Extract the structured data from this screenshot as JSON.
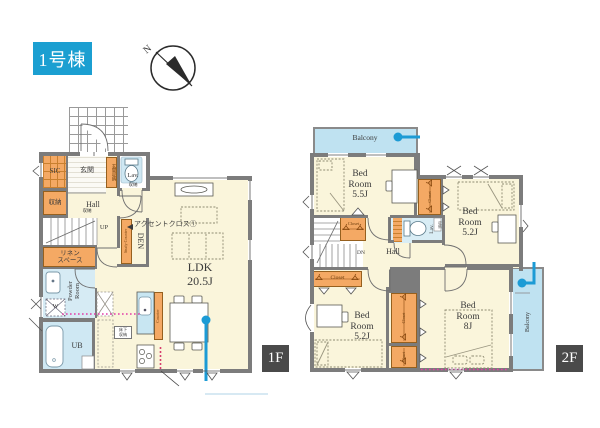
{
  "header": {
    "building": "1号棟",
    "compass_north": "N"
  },
  "floor1": {
    "badge": "1F",
    "sic": "SIC",
    "genkan": "玄関",
    "genkan_storage": "玄関収納",
    "lav": "Lav.",
    "lav_storage": "収納",
    "storage": "収納",
    "hall": "Hall",
    "hall_storage": "収納",
    "up": "UP",
    "linen": "リネン\nスペース",
    "powder": "Powder\nRoom",
    "washer": "W",
    "ub": "UB",
    "den": "DEN",
    "study_counter": "Study Counter",
    "accent_note": "アクセントクロス①",
    "ldk": "LDK\n20.5J",
    "counter": "Counter",
    "floor_storage": "床下\n収納"
  },
  "floor2": {
    "badge": "2F",
    "balcony_top": "Balcony",
    "balcony_right": "Balcony",
    "bedroom_a": "Bed\nRoom\n5.5J",
    "bedroom_b": "Bed\nRoom\n5.2J",
    "bedroom_c": "Bed\nRoom\n5.2J",
    "bedroom_d": "Bed\nRoom\n8J",
    "hall": "Hall",
    "dn": "DN",
    "lav": "Lav.",
    "lav_storage": "収納",
    "closet": "Closet"
  },
  "colors": {
    "title_bg": "#1B9FD1",
    "accent_cyan": "#1C9BD5",
    "closet_orange": "#F4A964",
    "balcony_blue": "#BFE2F1",
    "bath_blue": "#CFE8F3",
    "floor_cream": "#FAF5DB",
    "wall_gray": "#7C7C7C",
    "badge_gray": "#4A4A4A",
    "magenta_dots": "#E23DA8"
  }
}
